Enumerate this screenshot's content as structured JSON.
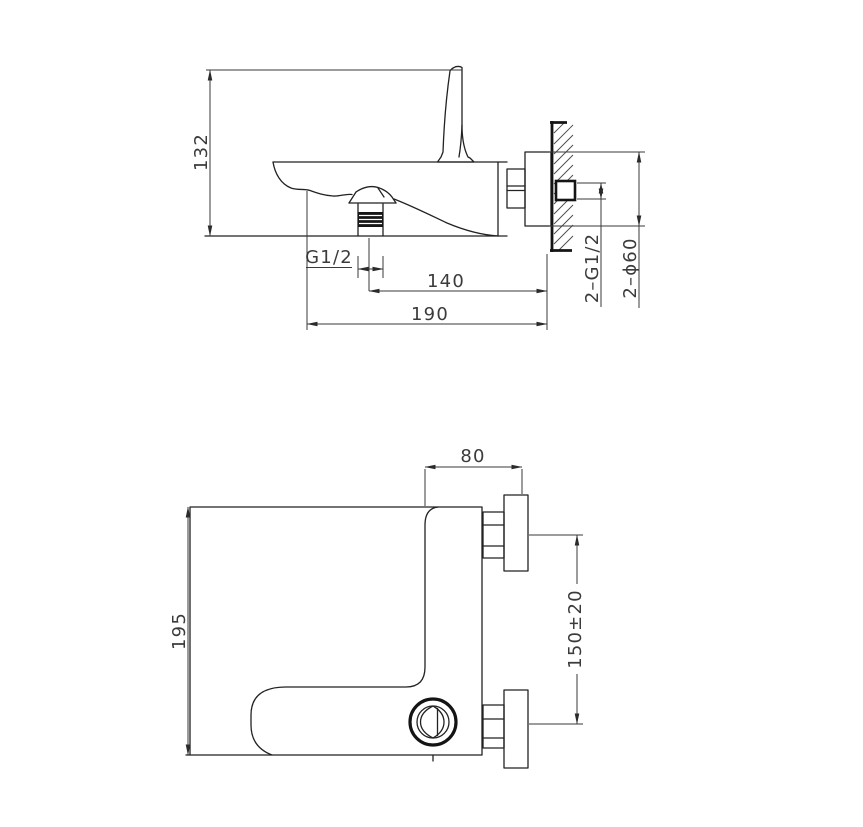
{
  "drawing": {
    "side_view": {
      "height": "132",
      "spout_thread": "G1/2",
      "spout_to_wall": "140",
      "total_depth": "190",
      "inlet_thread": "2–G1/2",
      "flange_diameter": "2–ϕ60"
    },
    "front_view": {
      "top_offset": "80",
      "body_height": "195",
      "inlet_spacing": "150±20"
    }
  }
}
